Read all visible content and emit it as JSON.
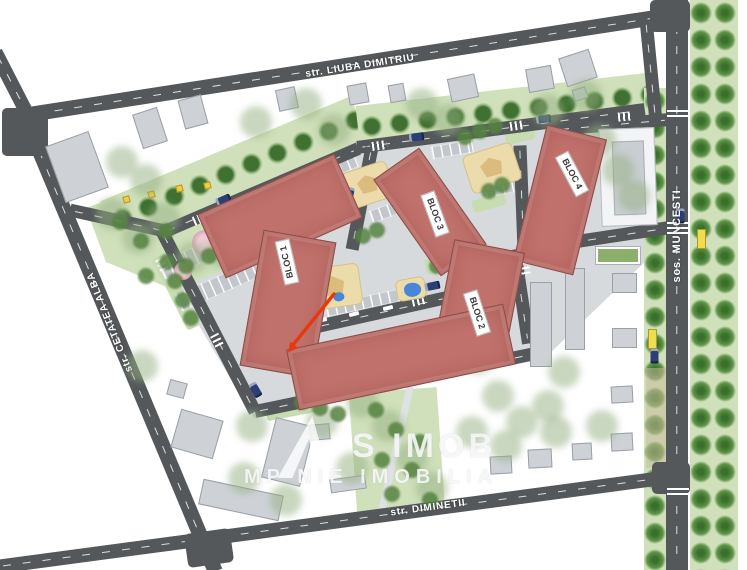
{
  "plan": {
    "streets": {
      "top": "str. LIUBA DIMITRIU",
      "left": "str. CETATEA ALBA",
      "right": "sos. MUNCESTI",
      "bottom": "str. DIMINETII"
    },
    "blocks": {
      "bloc1": "BLOC 1",
      "bloc2": "BLOC 2",
      "bloc3": "BLOC 3",
      "bloc4": "BLOC 4"
    },
    "watermark": {
      "line1": "S IMOB",
      "line2": "MP NIE IMOBILIA"
    },
    "colors": {
      "road": "#54585b",
      "block": "#c1716b",
      "block_border": "#8e4a45",
      "existing": "#ced2d7",
      "existing_border": "#9aa0a7",
      "green": "#cfe0ba",
      "green_dark": "#5e9348",
      "pavement": "#d7dadc",
      "parking": "#c3c7cb",
      "playground": "#ecdcab",
      "pool": "#4a86d8",
      "pink_tree": "#e5b4c4",
      "bench": "#f2cf3e",
      "arrow": "#e8380e",
      "label_bg": "#ffffff",
      "label_text": "#3a3a3a"
    }
  }
}
